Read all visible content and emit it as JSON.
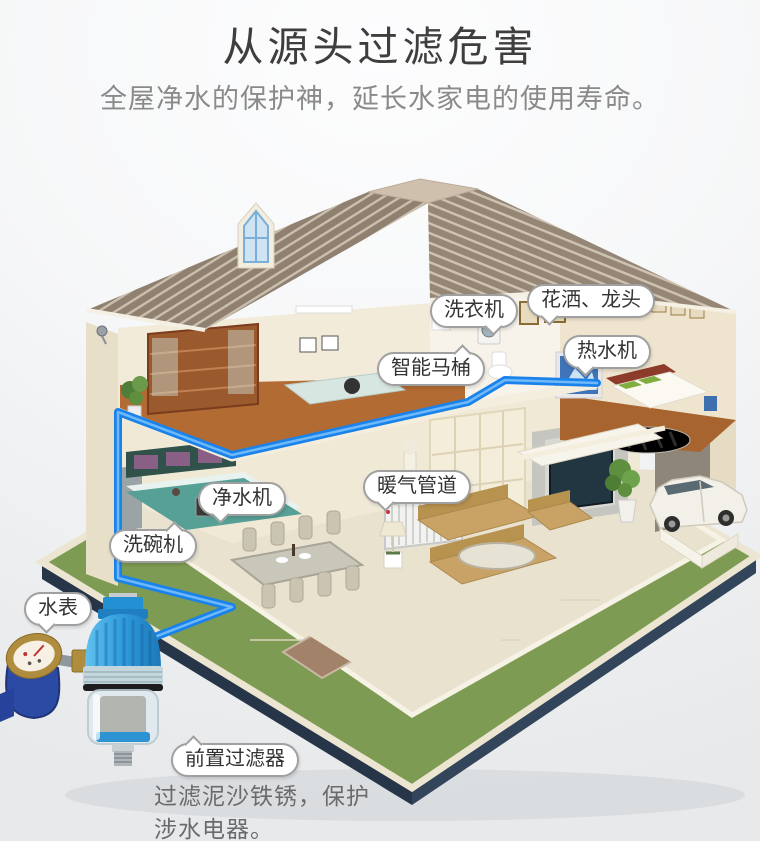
{
  "header": {
    "title": "从源头过滤危害",
    "subtitle": "全屋净水的保护神，延长水家电的使用寿命。"
  },
  "labels": {
    "washing_machine": "洗衣机",
    "shower_faucet": "花洒、龙头",
    "water_heater": "热水机",
    "smart_toilet": "智能马桶",
    "water_purifier": "净水机",
    "heating_pipes": "暖气管道",
    "dishwasher": "洗碗机",
    "water_meter": "水表",
    "prefilter": "前置过滤器"
  },
  "footnote": {
    "line1": "过滤泥沙铁锈，保护",
    "line2": "涉水电器。"
  },
  "colors": {
    "pipe_blue": "#1b82ea",
    "filter_blue": "#2e9fe0",
    "meter_blue": "#2b4aa3",
    "grass_green": "#7d9b52",
    "platform_navy": "#2e3e50",
    "roof_brown": "#8f8070",
    "wall_cream": "#f0e9d6",
    "wood_floor": "#b06a33",
    "title_text": "#3e3e3e",
    "subtitle_text": "#8a8a8a",
    "label_text": "#333333"
  }
}
